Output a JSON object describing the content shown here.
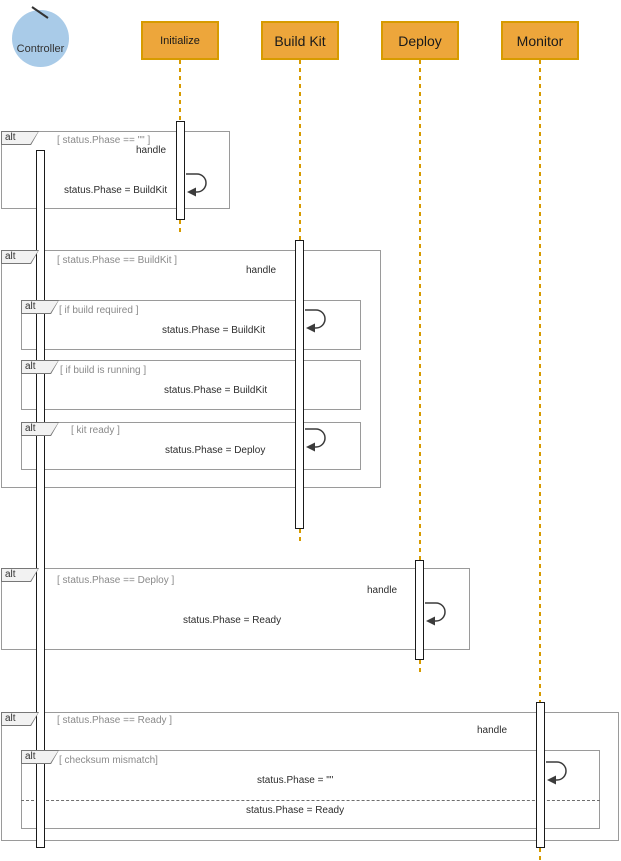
{
  "diagram": {
    "actor": {
      "label": "Controller"
    },
    "participants": [
      {
        "label": "Initialize"
      },
      {
        "label": "Build Kit"
      },
      {
        "label": "Deploy"
      },
      {
        "label": "Monitor"
      }
    ],
    "fragments": [
      {
        "operator": "alt",
        "condition": "[ status.Phase == \"\" ]"
      },
      {
        "operator": "alt",
        "condition": "[ status.Phase == BuildKit ]"
      },
      {
        "operator": "alt",
        "condition": "[ if build required ]"
      },
      {
        "operator": "alt",
        "condition": "[ if build is running ]"
      },
      {
        "operator": "alt",
        "condition": "[ kit ready ]"
      },
      {
        "operator": "alt",
        "condition": "[ status.Phase == Deploy ]"
      },
      {
        "operator": "alt",
        "condition": "[ status.Phase == Ready ]"
      },
      {
        "operator": "alt",
        "condition": "[ checksum mismatch]"
      }
    ],
    "messages": [
      {
        "label": "handle"
      },
      {
        "label": "status.Phase = BuildKit"
      },
      {
        "label": "handle"
      },
      {
        "label": "status.Phase = BuildKit"
      },
      {
        "label": "status.Phase = BuildKit"
      },
      {
        "label": "status.Phase = Deploy"
      },
      {
        "label": "handle"
      },
      {
        "label": "status.Phase = Ready"
      },
      {
        "label": "handle"
      },
      {
        "label": "status.Phase = \"\""
      },
      {
        "label": "status.Phase = Ready"
      }
    ],
    "colors": {
      "participant_fill": "#eda63b",
      "participant_border": "#d79b00",
      "lifeline": "#d79b00",
      "actor_fill": "#a9cbe8",
      "frame_border": "#9a9a9a",
      "condition_text": "#8a8a8a",
      "message_text": "#2d2d2d"
    }
  }
}
